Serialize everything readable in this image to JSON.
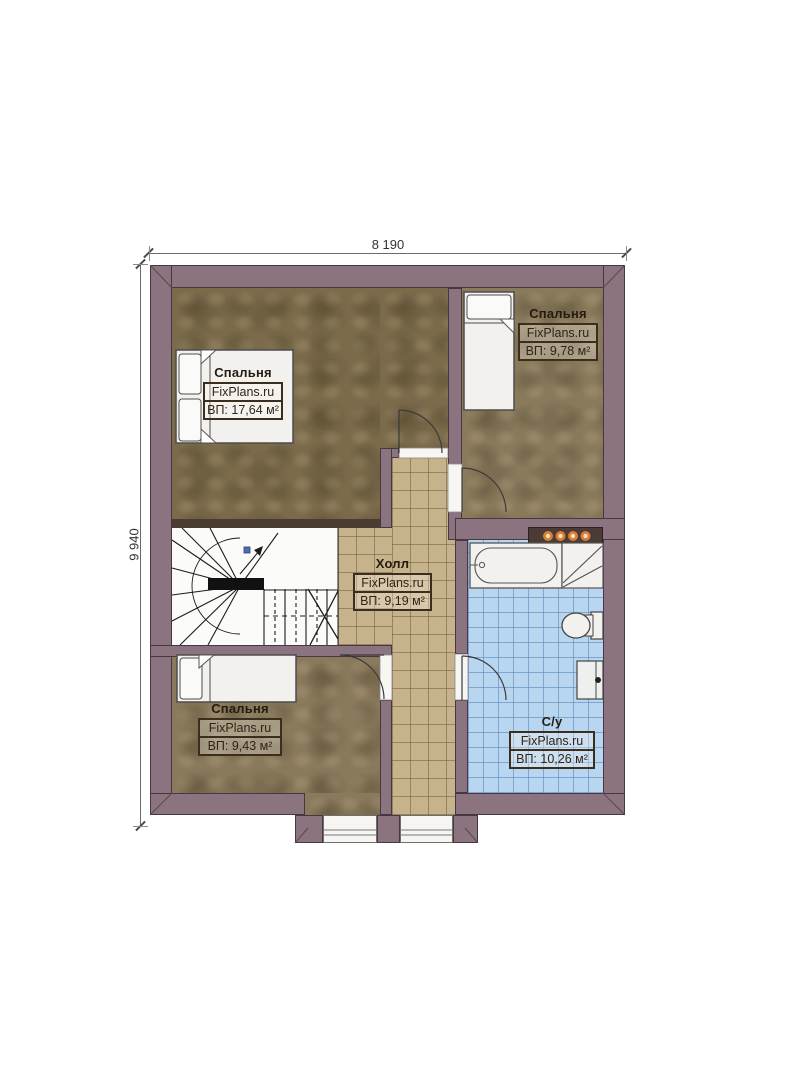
{
  "dimensions": {
    "width_label": "8 190",
    "height_label": "9 940"
  },
  "rooms": [
    {
      "id": "bedroom-1",
      "name": "Спальня",
      "brand": "FixPlans.ru",
      "area": "ВП: 17,64 м²"
    },
    {
      "id": "bedroom-2",
      "name": "Спальня",
      "brand": "FixPlans.ru",
      "area": "ВП: 9,78 м²"
    },
    {
      "id": "hall",
      "name": "Холл",
      "brand": "FixPlans.ru",
      "area": "ВП: 9,19 м²"
    },
    {
      "id": "bedroom-3",
      "name": "Спальня",
      "brand": "FixPlans.ru",
      "area": "ВП: 9,43 м²"
    },
    {
      "id": "bathroom",
      "name": "С/у",
      "brand": "FixPlans.ru",
      "area": "ВП: 10,26 м²"
    }
  ],
  "colors": {
    "wall": "#8b737f",
    "wall_edge": "#463741",
    "bedroom1_floor": "#7b6b4b",
    "bedroom_floor": "#8a7a5c",
    "hall_tile": "#c6b38b",
    "bath_tile": "#b9d6f1",
    "fixture": "#f2f1ee",
    "light_dot": "#d67f38"
  }
}
